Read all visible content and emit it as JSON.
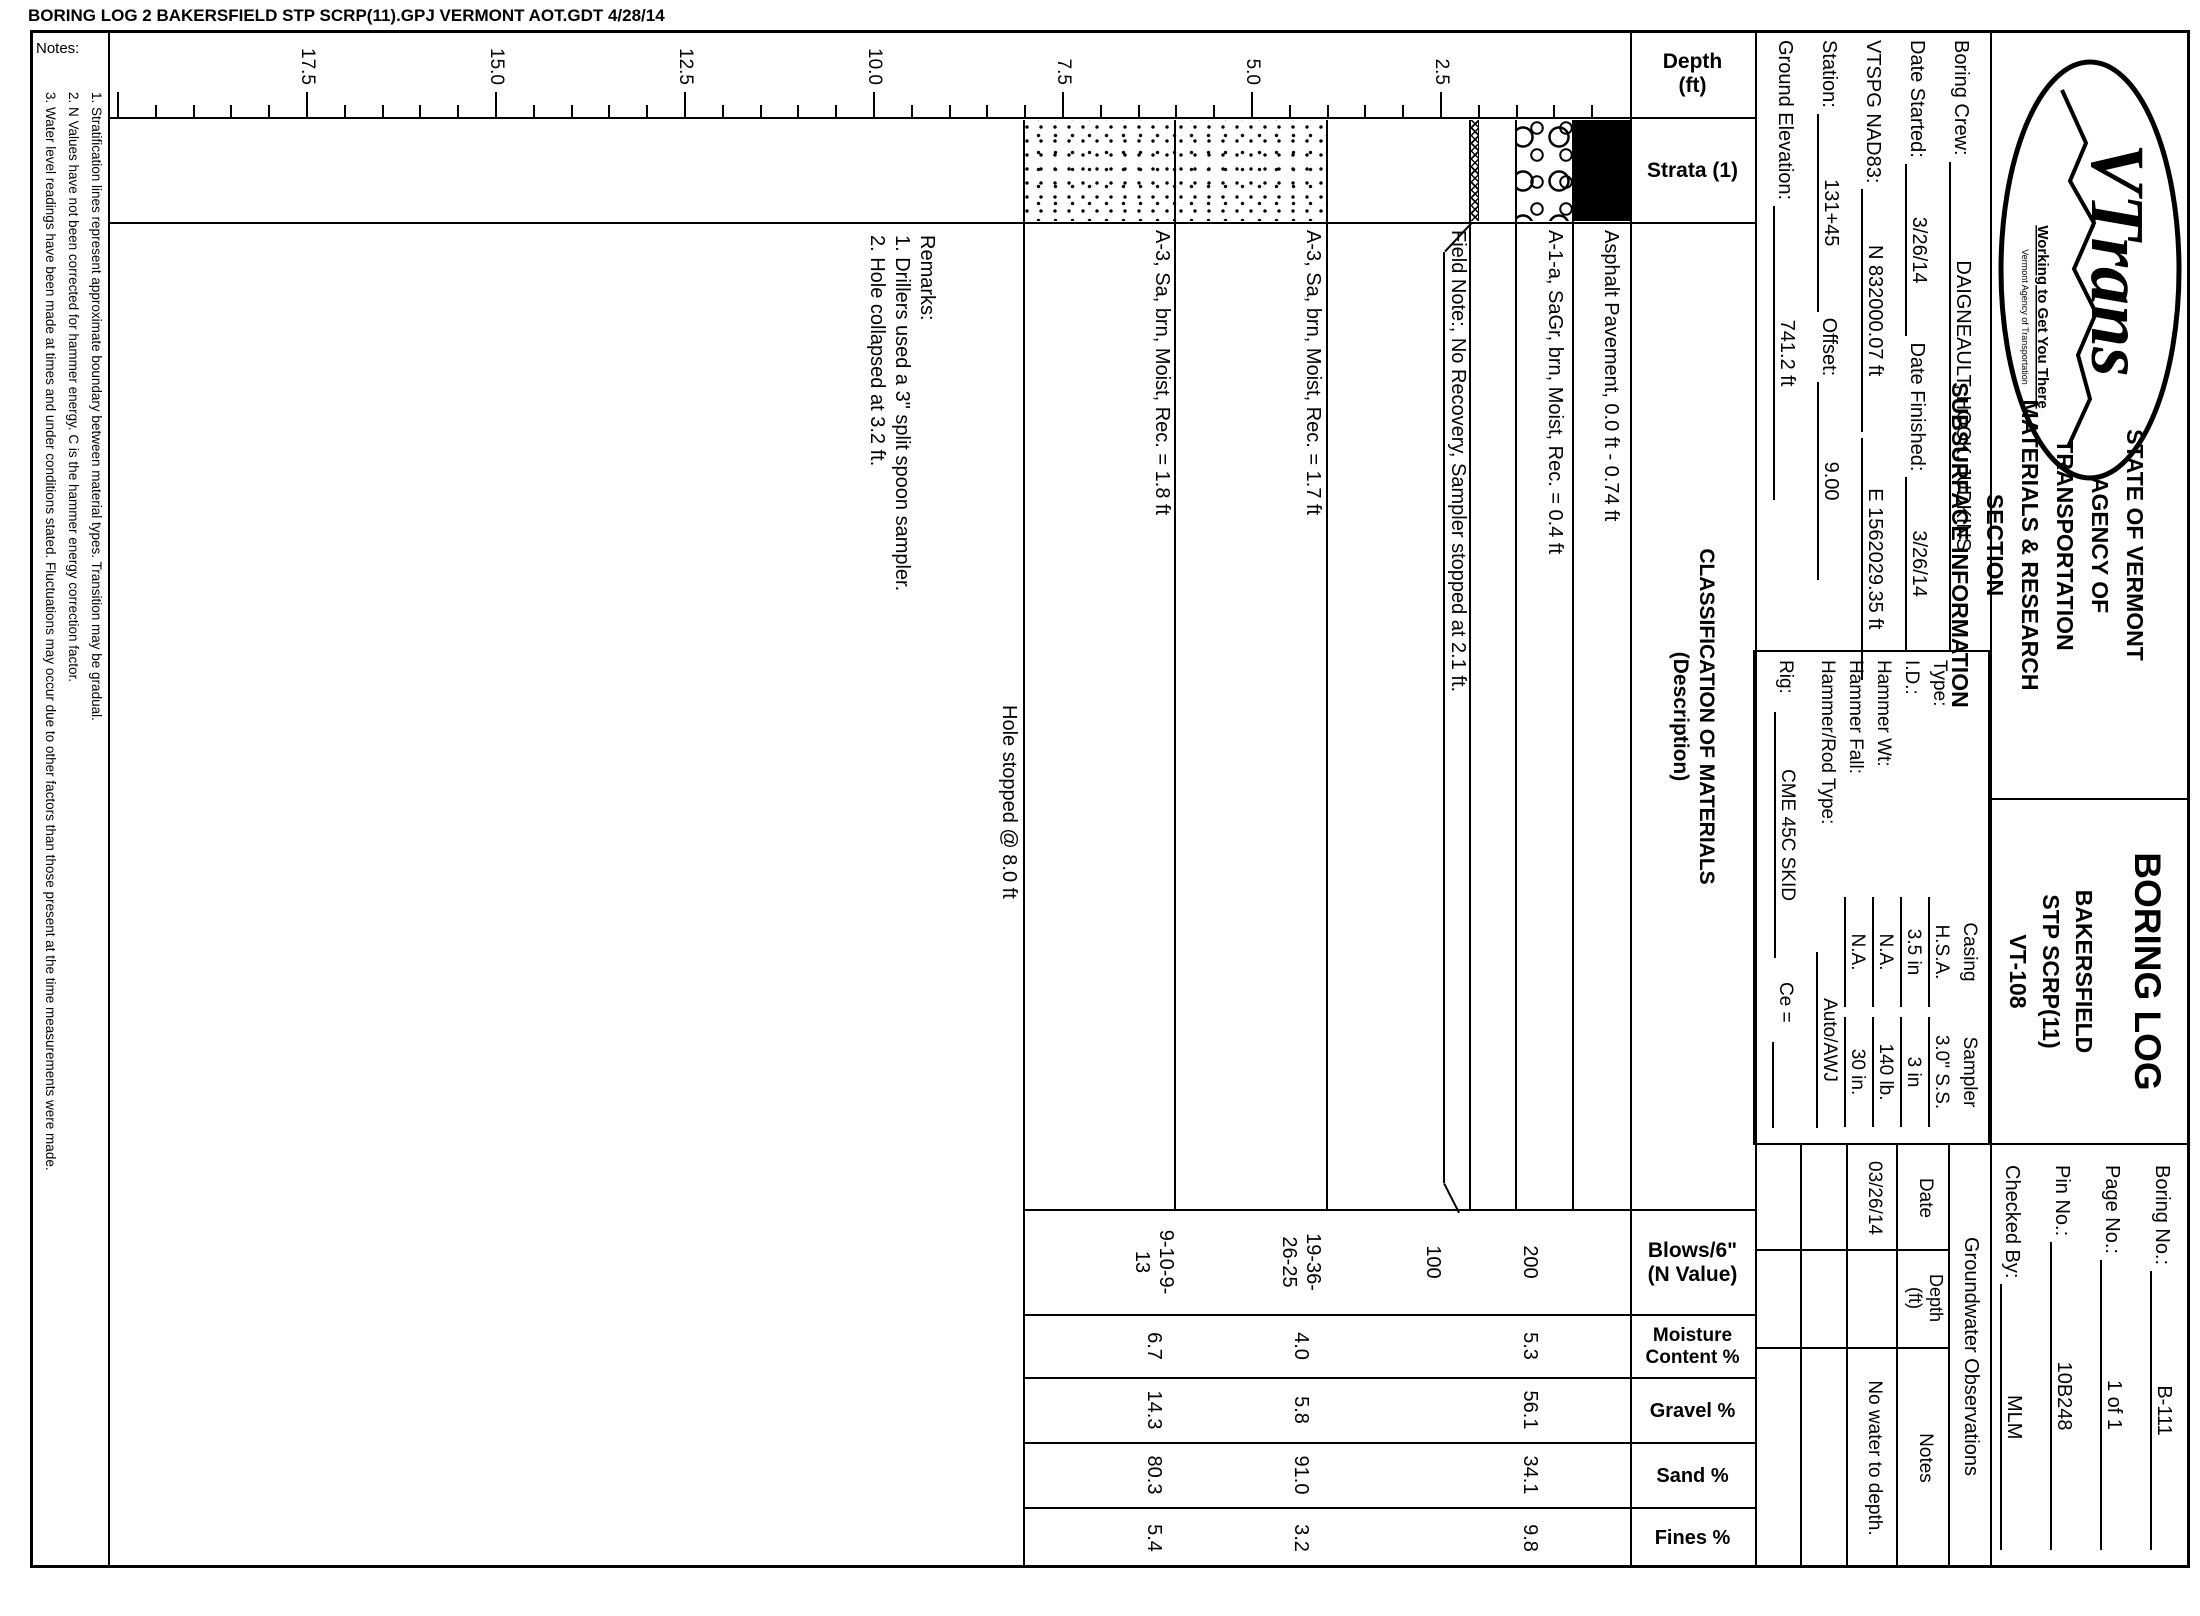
{
  "file_header": "BORING LOG  2 BAKERSFIELD STP SCRP(11).GPJ  VERMONT AOT.GDT  4/28/14",
  "title_block": {
    "logo": {
      "brand": "VTrans",
      "tagline": "Working to Get You There",
      "subtext": "Vermont Agency of Transportation"
    },
    "agency_lines": [
      "STATE OF VERMONT",
      "AGENCY OF TRANSPORTATION",
      "MATERIALS & RESEARCH SECTION",
      "SUBSURFACE INFORMATION"
    ],
    "report_title": "BORING LOG",
    "project": {
      "town": "BAKERSFIELD",
      "number": "STP SCRP(11)",
      "road": "VT-108"
    },
    "fields": [
      {
        "label": "Boring No.:",
        "value": "B-111"
      },
      {
        "label": "Page No.:",
        "value": "1 of 1"
      },
      {
        "label": "Pin No.:",
        "value": "10B248"
      },
      {
        "label": "Checked By:",
        "value": "MLM"
      }
    ]
  },
  "boring_info": {
    "boring_crew_label": "Boring Crew:",
    "boring_crew": "DAIGNEAULT, HOOK, JUDKINS",
    "date_started_label": "Date Started:",
    "date_started": "3/26/14",
    "date_finished_label": "Date Finished:",
    "date_finished": "3/26/14",
    "vtspg_label": "VTSPG NAD83:",
    "northing": "N 832000.07 ft",
    "easting": "E 1562029.35 ft",
    "station_label": "Station:",
    "station": "131+45",
    "offset_label": "Offset:",
    "offset": "9.00",
    "ground_elevation_label": "Ground Elevation:",
    "ground_elevation": "741.2 ft"
  },
  "equipment": {
    "col_headers": [
      "Casing",
      "Sampler"
    ],
    "rows": [
      {
        "label": "Type:",
        "casing": "H.S.A.",
        "sampler": "3.0\" S.S."
      },
      {
        "label": "I.D.:",
        "casing": "3.5 in",
        "sampler": "3 in"
      },
      {
        "label": "Hammer Wt:",
        "casing": "N.A.",
        "sampler": "140 lb."
      },
      {
        "label": "Hammer Fall:",
        "casing": "N.A.",
        "sampler": "30 in."
      }
    ],
    "rod_label": "Hammer/Rod Type:",
    "rod": "Auto/AWJ",
    "rig_label": "Rig:",
    "rig": "CME 45C SKID",
    "ce_label": "Ce ="
  },
  "groundwater": {
    "title": "Groundwater Observations",
    "date_header": "Date",
    "depth_header": "Depth\n(ft)",
    "notes_header": "Notes",
    "rows": [
      {
        "date": "03/26/14",
        "depth": "",
        "notes": "No water to depth."
      }
    ]
  },
  "log": {
    "headers": {
      "depth": "Depth\n(ft)",
      "strata": "Strata (1)",
      "classification": "CLASSIFICATION OF MATERIALS\n(Description)",
      "blows": "Blows/6\"\n(N Value)",
      "moisture": "Moisture\nContent %",
      "gravel": "Gravel %",
      "sand": "Sand %",
      "fines": "Fines %"
    },
    "axis": {
      "tick_labels": [
        "2.5",
        "5.0",
        "7.5",
        "10.0",
        "12.5",
        "15.0",
        "17.5"
      ],
      "minor_step_ft": 0.5,
      "major_step_ft": 2.5,
      "max_ft": 20,
      "px_per_ft": 75.6,
      "zero_y": 570
    },
    "strata_layers": [
      {
        "material": "asphalt",
        "pattern": "solid",
        "top_ft": 0,
        "bottom_ft": 0.74
      },
      {
        "material": "gravel",
        "pattern": "circles",
        "top_ft": 0.74,
        "bottom_ft": 1.5
      },
      {
        "material": "no-recovery",
        "pattern": "crosshatch",
        "top_ft": 2.0,
        "bottom_ft": 2.1
      },
      {
        "material": "sand",
        "pattern": "dots",
        "top_ft": 4.0,
        "bottom_ft": 8.0
      }
    ],
    "boundary_lines_ft": [
      0.74,
      1.5,
      2.1,
      4.0,
      6.0
    ],
    "hole_bottom_ft": 8.0,
    "entries": [
      {
        "description": "Asphalt Pavement, 0.0 ft - 0.74 ft",
        "text_top_ft": 0.1
      },
      {
        "description": "A-1-a, SaGr, brn, Moist, Rec. = 0.4 ft",
        "text_top_ft": 0.85,
        "values_mid_ft": 1.32,
        "blows": "200",
        "moisture": "5.3",
        "gravel": "56.1",
        "sand": "34.1",
        "fines": "9.8"
      },
      {
        "description": "Field Note:, No Recovery, Sampler stopped at 2.1 ft.",
        "text_top_ft": 2.13,
        "values_mid_ft": 2.6,
        "blows": "100"
      },
      {
        "description": "A-3, Sa, brn, Moist, Rec. = 1.7 ft",
        "text_top_ft": 4.05,
        "values_mid_ft": 4.35,
        "blows": "19-36-\n26-25",
        "moisture": "4.0",
        "gravel": "5.8",
        "sand": "91.0",
        "fines": "3.2"
      },
      {
        "description": "A-3, Sa, brn, Moist, Rec. = 1.8 ft",
        "text_top_ft": 6.05,
        "values_mid_ft": 6.3,
        "blows": "9-10-9-\n13",
        "moisture": "6.7",
        "gravel": "14.3",
        "sand": "80.3",
        "fines": "5.4"
      }
    ],
    "hole_stopped_text": "Hole stopped @ 8.0 ft",
    "remarks": [
      "Remarks:",
      "1. Drillers used a 3\" split spoon sampler.",
      "2. Hole collapsed at 3.2 ft."
    ]
  },
  "notes": {
    "label": "Notes:",
    "items": [
      "1. Stratification lines represent approximate boundary between material types. Transition may be gradual.",
      "2. N Values have not been corrected for hammer energy. C is the hammer energy correction factor.",
      "3. Water level readings have been made at times and under conditions stated. Fluctuations may occur due to other factors than those present at the time measurements were made."
    ]
  },
  "colors": {
    "ink": "#000000",
    "paper": "#ffffff"
  }
}
